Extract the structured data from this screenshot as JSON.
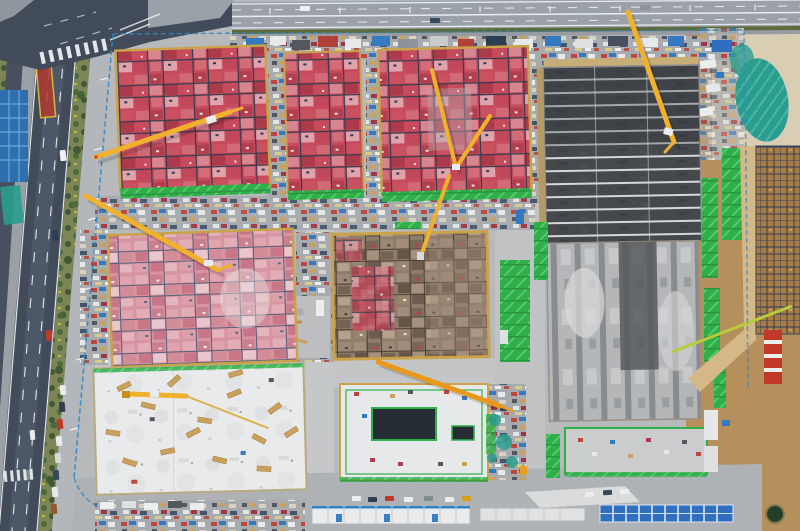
{
  "scene": {
    "description": "Aerial top-down drone view of a large construction site: red formwork building decks, a pink formwork block, a brown deck, a dark waterproofed slab with white stripes, striped concrete slabs, a white foundation slab, a podium slab with a dark excavation pit, yellow tower cranes, green safety netting, staging yards with materials and containers, white site-office trailers, a blue-roofed dormitory block, dirt areas with rebar grids, a perimeter road, a multi-lane highway on the left and an expressway along the top."
  },
  "counts": {
    "tower_cranes_visible": 7,
    "formwork_building_blocks": 5,
    "concrete_slab_areas": 4,
    "excavation_pits": 2
  },
  "palette": {
    "site_concrete": "#b7b9bb",
    "road_dark": "#414b59",
    "road_service": "#46505e",
    "road_light": "#9aa1a9",
    "lane_white": "#f2f4f5",
    "hedge_green": "#5c6b3c",
    "red_panel": "#c64b5c",
    "pink_panel": "#d795a1",
    "brown_deck": "#8f7c6b",
    "grid_line": "#343c4e",
    "dark_slab": "#45484c",
    "slab_stripe": "#d6d7d8",
    "gray_slab": "#b4b6b8",
    "column_strip": "#898c8f",
    "white_slab": "#e9eaec",
    "gold_border": "#c9a24a",
    "green_net": "#2fae49",
    "teal_net": "#2a9d8f",
    "crane_yellow": "#f0b12c",
    "crane_orange": "#e8991c",
    "crane_lime": "#b8cc3a",
    "crane_red": "#c0392b",
    "fence_blue": "#2e86c9",
    "blue_roof": "#2f6fc2",
    "dirt_tan": "#b58f5c",
    "sand": "#d9cdb4",
    "rebar_brown": "#a87c42",
    "rebar_line": "#33405e",
    "pit_dark": "#262c33",
    "pond_green": "#23402a",
    "veg_green": "#7d8455",
    "tree_green": "#3f5a33",
    "marking_red": "#b03a30",
    "marking_yellow": "#e8c832",
    "clutter_base": "#a7abae",
    "path_gray": "#c3c5c7",
    "bottom_band": "#aeb2b5",
    "sidewalk": "#b3b7bb",
    "trailer_white": "#e9ebec"
  }
}
